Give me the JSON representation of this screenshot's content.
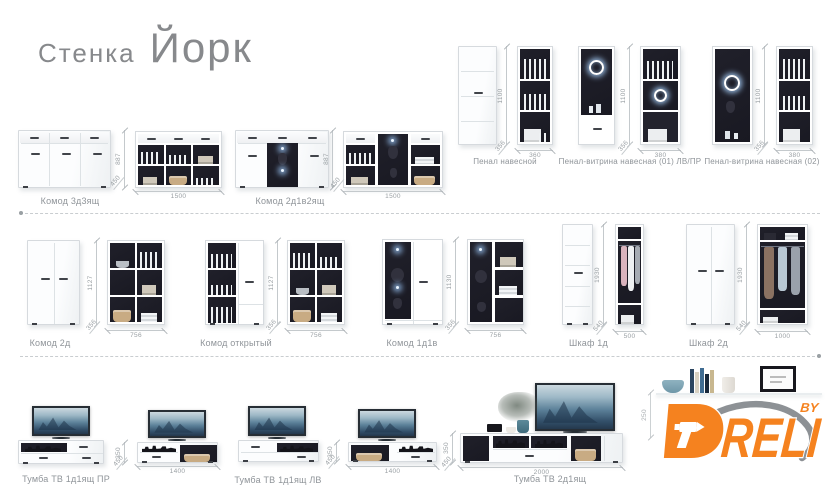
{
  "title": {
    "prefix": "Стенка",
    "name": "Йорк"
  },
  "brand": {
    "name": "DRELI",
    "initial": "D",
    "letters": "RELI",
    "by": "BY",
    "accent_color": "#f5821f"
  },
  "items": {
    "komod_3d3": {
      "label": "Комод 3д3ящ",
      "h": "887",
      "d": "450",
      "w": "1500"
    },
    "komod_2d1v2": {
      "label": "Комод 2д1в2ящ",
      "h": "887",
      "d": "450",
      "w": "1500"
    },
    "penal_nav": {
      "label": "Пенал навесной",
      "h": "1100",
      "d": "356",
      "w": "360"
    },
    "penal_v01": {
      "label": "Пенал-витрина навесная (01) ЛВ/ПР",
      "h": "1100",
      "d": "356",
      "w": "380"
    },
    "penal_v02": {
      "label": "Пенал-витрина навесная (02)",
      "h": "1100",
      "d": "356",
      "w": "380"
    },
    "komod_2d": {
      "label": "Комод 2д",
      "h": "1127",
      "d": "356",
      "w": "756"
    },
    "komod_open": {
      "label": "Комод открытый",
      "h": "1127",
      "d": "356",
      "w": "756"
    },
    "komod_1d1v": {
      "label": "Комод 1д1в",
      "h": "1130",
      "d": "356",
      "w": "756"
    },
    "shkaf_1d": {
      "label": "Шкаф 1д",
      "h": "1930",
      "d": "540",
      "w": "500"
    },
    "shkaf_2d": {
      "label": "Шкаф 2д",
      "h": "1930",
      "d": "540",
      "w": "1000"
    },
    "tv_pr": {
      "label": "Тумба ТВ 1д1ящ ПР",
      "h": "350",
      "d": "450",
      "w": "1400"
    },
    "tv_lv": {
      "label": "Тумба ТВ 1д1ящ ЛВ",
      "h": "350",
      "d": "450",
      "w": "1400"
    },
    "tv_2d": {
      "label": "Тумба ТВ 2д1ящ",
      "h": "350",
      "d": "450",
      "w": "2000"
    },
    "polka": {
      "h": "250"
    }
  }
}
